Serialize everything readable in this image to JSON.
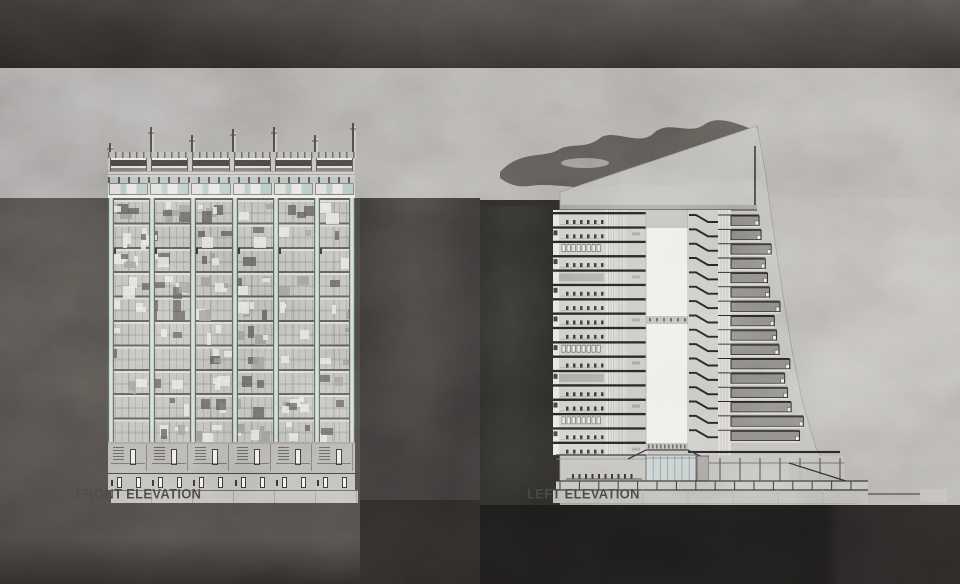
{
  "board": {
    "type": "architecture-elevation-presentation-board",
    "background": "stone-marble-photo-collage"
  },
  "front_elevation": {
    "label": "FRONT ELEVATION",
    "bays": 6,
    "masts": 7,
    "grid_floors": 10,
    "doors_per_bay": 2,
    "mullion_color": "#9db8b2",
    "panel_colors": [
      "#514f4c",
      "#e3e2de",
      "#848280"
    ]
  },
  "left_elevation": {
    "label": "LEFT ELEVATION",
    "floors": 17,
    "terrace_rows": 16,
    "chevron_rows": 16,
    "atrium_voids": 2,
    "glass_color": "#b9c2c1",
    "terrace_color": "#76746f",
    "ink_color": "#21201e",
    "paper_color": "#b2b0ab"
  },
  "palette": {
    "top_band": "#383634",
    "light_marble": "#9d9a96",
    "left_slate": "#3e3b38",
    "mid_slate": "#333130",
    "near_black": "#1d1b1a",
    "label_color": "#3a3938"
  }
}
